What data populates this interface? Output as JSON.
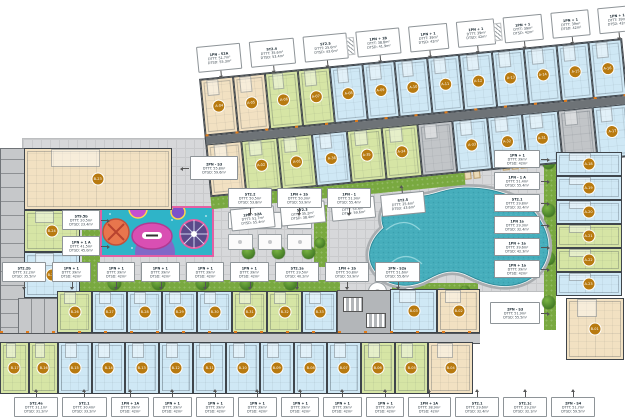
{
  "colors": {
    "unit_blue": "#cfe8f5",
    "unit_beige": "#f2e1c2",
    "unit_green": "#d6e5a5",
    "unit_gray": "#c2c5c8",
    "pool_water": "#46aebc",
    "playground_teal": "#2fb4c8",
    "playground_pink": "#e45fa3",
    "grass_green": "#79a940",
    "label_orange": "#b87a10",
    "paving_gray": "#d7d8da"
  },
  "block_a": {
    "top_callouts": [
      {
        "t": "1PN - S2A",
        "a": "DTTT: 51.7m²",
        "b": "DTSD: 55.3m²"
      },
      {
        "t": "ST2.4",
        "a": "DTTT: 35.6m²",
        "b": "DTSD: 53.4m²"
      },
      {
        "t": "ST2.5",
        "a": "DTTT: 25.6m²",
        "b": "DTSD: 43.6m²"
      },
      {
        "t": "1PN + 1B",
        "a": "DTTT: 38.8m²",
        "b": "DTSD: 41.9m²"
      },
      {
        "t": "1PN + 1",
        "a": "DTTT: 39m²",
        "b": "DTSD: 42m²"
      },
      {
        "t": "1PN + 1",
        "a": "DTTT: 39m²",
        "b": "DTSD: 42m²"
      },
      {
        "t": "1PN + 1",
        "a": "DTTT: 39m²",
        "b": "DTSD: 42m²"
      },
      {
        "t": "1PN + 1",
        "a": "DTTT: 39m²",
        "b": "DTSD: 42m²"
      },
      {
        "t": "1PN + 1",
        "a": "DTTT: 39m²",
        "b": "DTSD: 42m²"
      },
      {
        "t": "1PN + 1",
        "a": "DTTT: 39m²",
        "b": "DTSD: 42m²"
      }
    ],
    "top_row": [
      {
        "n": "A-04",
        "c": "be"
      },
      {
        "n": "A-05",
        "c": "be"
      },
      {
        "n": "A-06",
        "c": "gr"
      },
      {
        "n": "A-07",
        "c": "gr"
      },
      {
        "n": "A-08",
        "c": "bl"
      },
      {
        "n": "A-09",
        "c": "bl"
      },
      {
        "n": "A-10",
        "c": "bl"
      },
      {
        "n": "A-11",
        "c": "bl"
      },
      {
        "n": "A-12",
        "c": "bl"
      },
      {
        "n": "A-13",
        "c": "bl"
      },
      {
        "n": "A-14",
        "c": "bl"
      },
      {
        "n": "A-15",
        "c": "bl"
      },
      {
        "n": "A-16",
        "c": "bl"
      }
    ],
    "second_row": [
      {
        "n": "A-03",
        "c": "be"
      },
      {
        "n": "A-02",
        "c": "gr"
      },
      {
        "n": "A-01",
        "c": "gr"
      },
      {
        "n": "A-36",
        "c": "bl"
      },
      {
        "n": "A-35",
        "c": "gr"
      },
      {
        "n": "A-34",
        "c": "gr"
      },
      {
        "n": "",
        "c": "gy"
      },
      {
        "n": "A-33",
        "c": "bl"
      },
      {
        "n": "A-32",
        "c": "bl"
      },
      {
        "n": "A-31",
        "c": "bl"
      },
      {
        "n": "",
        "c": "gy"
      },
      {
        "n": "A-17",
        "c": "bl"
      }
    ],
    "band_bottom_callouts": [
      {
        "t": "1PN - S2A",
        "a": "DTTT: 51.7m²",
        "b": "DTSD: 55.4m²"
      },
      {
        "t": "ST2.3",
        "a": "DTTT: 35.2m²",
        "b": "DTSD: 38.4m²"
      },
      {
        "t": "2PN - S2",
        "a": "DTTT: 55.6m²",
        "b": "DTSD: 59.6m²"
      },
      {
        "t": "ST2.5",
        "a": "DTTT: 25.6m²",
        "b": "DTSD: 43.6m²"
      }
    ],
    "right_strip": [
      {
        "n": "A-18",
        "c": "bl"
      },
      {
        "n": "A-19",
        "c": "bl"
      },
      {
        "n": "A-20",
        "c": "bl"
      },
      {
        "n": "A-21",
        "c": "gr"
      },
      {
        "n": "A-22",
        "c": "gr"
      },
      {
        "n": "A-23",
        "c": "bl"
      }
    ],
    "right_callouts": [
      {
        "t": "1PN + 1",
        "a": "DTTT: 39m²",
        "b": "DTSD: 42m²"
      },
      {
        "t": "1PN - 1 A",
        "a": "DTTT: 51.4m²",
        "b": "DTSD: 55.4m²"
      },
      {
        "t": "ST2.1",
        "a": "DTTT: 29.8m²",
        "b": "DTSD: 32.4m²"
      },
      {
        "t": "1PN 1a",
        "a": "DTTT: 29.3m²",
        "b": "DTSD: 32.4m²"
      },
      {
        "t": "1PN + 1a",
        "a": "DTTT: 39.6m²",
        "b": "DTSD: 42.3m²"
      },
      {
        "t": "1PN + 1a",
        "a": "DTTT: 39m²",
        "b": "DTSD: 42m²"
      }
    ]
  },
  "block_b": {
    "left_callout": {
      "t": "2PN - S3",
      "a": "DTTT: 55.8m²",
      "b": "DTSD: 59.6m²"
    },
    "left_column": [
      {
        "n": "B-23",
        "c": "be"
      },
      {
        "n": "B-24",
        "c": "gr"
      },
      {
        "n": "B-25",
        "c": "bl"
      }
    ],
    "upper_row": [
      {
        "n": "B-26",
        "c": "gr"
      },
      {
        "n": "B-27",
        "c": "bl"
      },
      {
        "n": "B-28",
        "c": "bl"
      },
      {
        "n": "B-29",
        "c": "bl"
      },
      {
        "n": "B-30",
        "c": "bl"
      },
      {
        "n": "B-31",
        "c": "gr"
      },
      {
        "n": "B-32",
        "c": "gr"
      },
      {
        "n": "B-33",
        "c": "bl"
      }
    ],
    "upper_right": [
      {
        "n": "B-03",
        "c": "bl"
      },
      {
        "n": "B-02",
        "c": "be"
      }
    ],
    "lower_row": [
      {
        "n": "B-17",
        "c": "gr"
      },
      {
        "n": "B-16",
        "c": "gr"
      },
      {
        "n": "B-15",
        "c": "bl"
      },
      {
        "n": "B-14",
        "c": "bl"
      },
      {
        "n": "B-13",
        "c": "bl"
      },
      {
        "n": "B-12",
        "c": "bl"
      },
      {
        "n": "B-11",
        "c": "bl"
      },
      {
        "n": "B-10",
        "c": "bl"
      },
      {
        "n": "B-09",
        "c": "bl"
      },
      {
        "n": "B-08",
        "c": "bl"
      },
      {
        "n": "B-07",
        "c": "bl"
      },
      {
        "n": "B-06",
        "c": "gr"
      },
      {
        "n": "B-05",
        "c": "gr"
      },
      {
        "n": "B-04",
        "c": "be"
      }
    ],
    "detached_unit": {
      "n": "B-01",
      "c": "be"
    },
    "detached_callout": {
      "t": "2PN - S3",
      "a": "DTTT: 51.9m²",
      "b": "DTSD: 55.5m²"
    },
    "bottom_callouts": [
      {
        "t": "ST2.4a",
        "a": "DTTT: 31.1m²",
        "b": "DTSD: 31.2m²"
      },
      {
        "t": "ST2.1",
        "a": "DTTT: 30.4m²",
        "b": "DTSD: 33.2m²"
      },
      {
        "t": "1PN + 1A",
        "a": "DTTT: 39m²",
        "b": "DTSD: 42m²"
      },
      {
        "t": "1PN + 1",
        "a": "DTTT: 39m²",
        "b": "DTSD: 42m²"
      },
      {
        "t": "1PN + 1",
        "a": "DTTT: 39m²",
        "b": "DTSD: 42m²"
      },
      {
        "t": "1PN + 1",
        "a": "DTTT: 39m²",
        "b": "DTSD: 42m²"
      },
      {
        "t": "1PN + 1",
        "a": "DTTT: 39m²",
        "b": "DTSD: 42m²"
      },
      {
        "t": "1PN + 1",
        "a": "DTTT: 39m²",
        "b": "DTSD: 42m²"
      },
      {
        "t": "1PN + 1",
        "a": "DTTT: 39m²",
        "b": "DTSD: 42m²"
      },
      {
        "t": "1PN + 1A",
        "a": "DTTT: 38.9m²",
        "b": "DTSD: 42m²"
      },
      {
        "t": "ST2.1",
        "a": "DTTT: 29.6m²",
        "b": "DTSD: 32.4m²"
      },
      {
        "t": "ST2.1c",
        "a": "DTTT: 29.2m²",
        "b": "DTSD: 32.1m²"
      },
      {
        "t": "2PN - S4",
        "a": "DTTT: 51.7m²",
        "b": "DTSD: 59.5m²"
      }
    ]
  },
  "courtyard": {
    "playground_callouts": [
      {
        "t": "ST9.5b",
        "a": "DTTT: 20.5m²",
        "b": "DTSD: 23.4m²"
      },
      {
        "t": "1PN + 1 A",
        "a": "DTTT: 41.5m²",
        "b": "DTSD: 45.0m²"
      }
    ],
    "mid_callouts": [
      {
        "t": "ST2.2b",
        "a": "DTTT: 32.2m²",
        "b": "DTSD: 35.5m²"
      },
      {
        "t": "1PN + 1",
        "a": "DTTT: 39m²",
        "b": "DTSD: 42m²"
      },
      {
        "t": "1PN + 1",
        "a": "DTTT: 39m²",
        "b": "DTSD: 42m²"
      },
      {
        "t": "1PN + 1",
        "a": "DTTT: 39m²",
        "b": "DTSD: 42m²"
      },
      {
        "t": "1PN + 1",
        "a": "DTTT: 39m²",
        "b": "DTSD: 42m²"
      },
      {
        "t": "1PN + 1",
        "a": "DTTT: 39m²",
        "b": "DTSD: 42m²"
      },
      {
        "t": "ST2.1a",
        "a": "DTTT: 29.5m²",
        "b": "DTSD: 40.2m²"
      },
      {
        "t": "1PN + 1b",
        "a": "DTTT: 50.8m²",
        "b": "DTSD: 53.9m²"
      },
      {
        "t": "1PN - S2a",
        "a": "DTTT: 51.6m²",
        "b": "DTSD: 55.6m²"
      }
    ],
    "pool_top_callouts": [
      {
        "t": "ST2.2",
        "a": "DTTT: 50.5m²",
        "b": "DTSD: 53.8m²"
      },
      {
        "t": "1PN + 1b",
        "a": "DTTT: 50.3m²",
        "b": "DTSD: 53.9m²"
      },
      {
        "t": "1PN - 1",
        "a": "DTTT: 51.9m²",
        "b": "DTSD: 55.4m²"
      }
    ]
  }
}
